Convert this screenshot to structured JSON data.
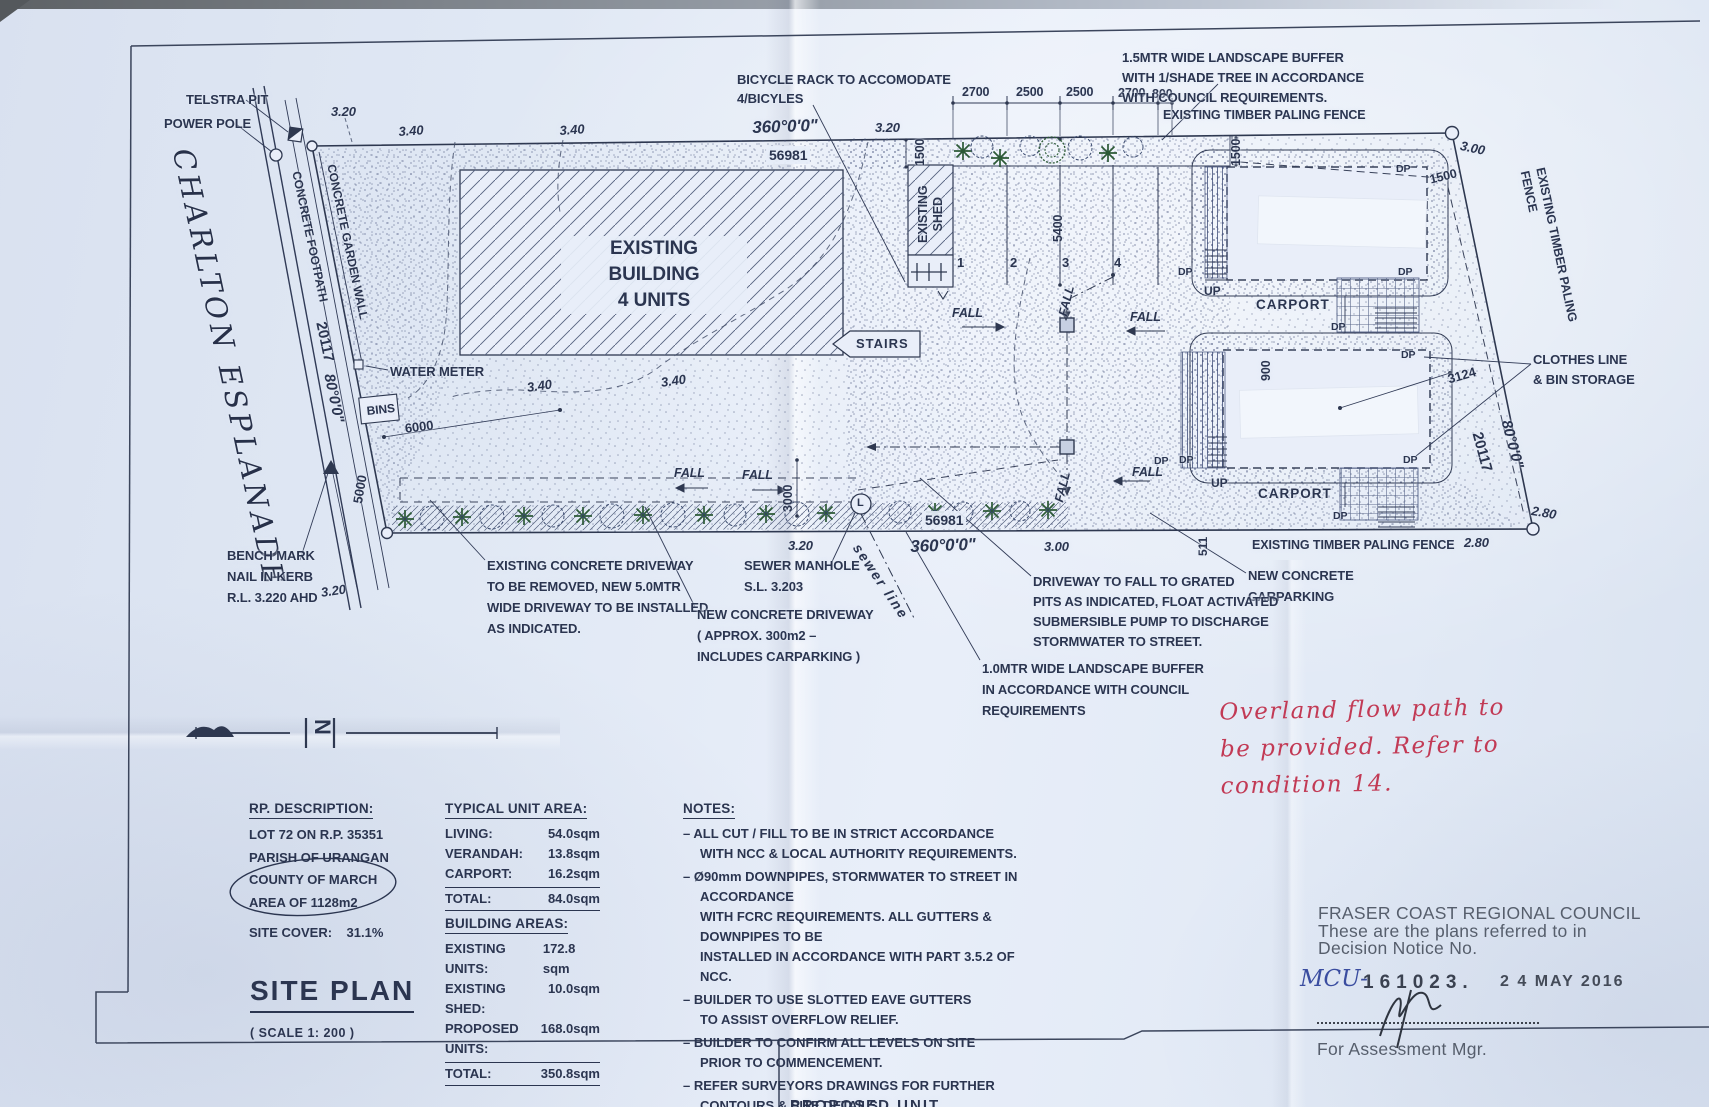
{
  "colors": {
    "ink": "#2b3550",
    "paper": "#e2e9f6",
    "red_pen": "#c23a55",
    "blue_pen": "#3a4da0",
    "tree_green": "#2c5a36",
    "stamp_gray": "#474f5c"
  },
  "plan_labels": [
    {
      "n": "telstra-pit-label",
      "t": "TELSTRA PIT",
      "x": 186,
      "y": 92
    },
    {
      "n": "power-pole-label",
      "t": "POWER POLE",
      "x": 164,
      "y": 116
    },
    {
      "n": "street-name",
      "t": "CHARLTON   ESPLANADE",
      "x": 200,
      "y": 145,
      "r": 78,
      "c": "street"
    },
    {
      "n": "level-320",
      "t": "3.20",
      "x": 331,
      "y": 104,
      "c": "dim"
    },
    {
      "n": "level-340",
      "t": "3.40",
      "x": 398,
      "y": 124,
      "c": "dim",
      "r": -4
    },
    {
      "n": "level-340",
      "t": "3.40",
      "x": 559,
      "y": 123,
      "c": "dim",
      "r": -4
    },
    {
      "n": "bearing-north",
      "t": "360°0'0\"",
      "x": 752,
      "y": 117,
      "s": 17,
      "c": "dim",
      "r": -2
    },
    {
      "n": "distance-north",
      "t": "56981",
      "x": 766,
      "y": 146,
      "s": 14,
      "bg": 1
    },
    {
      "n": "level-320",
      "t": "3.20",
      "x": 875,
      "y": 120,
      "c": "dim"
    },
    {
      "n": "dim-spacing",
      "t": "2700",
      "x": 962,
      "y": 84,
      "s": 12.5
    },
    {
      "n": "dim-spacing",
      "t": "2500",
      "x": 1016,
      "y": 84,
      "s": 12.5
    },
    {
      "n": "dim-spacing",
      "t": "2500",
      "x": 1066,
      "y": 84,
      "s": 12.5
    },
    {
      "n": "dim-spacing",
      "t": "2700",
      "x": 1118,
      "y": 85,
      "s": 12.5
    },
    {
      "n": "dim-spacing",
      "t": "800",
      "x": 1152,
      "y": 86,
      "s": 12.5
    },
    {
      "n": "note-landscape-buffer-1500",
      "t": "1.5MTR WIDE LANDSCAPE BUFFER\nWITH 1/SHADE TREE IN ACCORDANCE\nWITH COUNCIL REQUIREMENTS.",
      "x": 1122,
      "y": 48,
      "lh": 20
    },
    {
      "n": "fence-label-top",
      "t": "EXISTING TIMBER PALING FENCE",
      "x": 1163,
      "y": 107,
      "s": 12.5
    },
    {
      "n": "level-300",
      "t": "3.00",
      "x": 1462,
      "y": 138,
      "c": "dim",
      "r": 12
    },
    {
      "n": "dim-1500",
      "t": "1500",
      "x": 912,
      "y": 166,
      "r": -90,
      "s": 12.5
    },
    {
      "n": "existing-shed-label",
      "t": "EXISTING\nSHED",
      "x": 916,
      "y": 243,
      "r": -90,
      "s": 12.5,
      "lh": 15,
      "al": "center"
    },
    {
      "n": "dim-5400",
      "t": "5400",
      "x": 1050,
      "y": 242,
      "r": -90,
      "s": 12.5
    },
    {
      "n": "carpark-bay-number",
      "t": "1",
      "x": 957,
      "y": 255
    },
    {
      "n": "carpark-bay-number",
      "t": "2",
      "x": 1010,
      "y": 255
    },
    {
      "n": "carpark-bay-number",
      "t": "3",
      "x": 1062,
      "y": 255
    },
    {
      "n": "carpark-bay-number",
      "t": "4",
      "x": 1114,
      "y": 255
    },
    {
      "n": "dim-1500",
      "t": "1500",
      "x": 1228,
      "y": 166,
      "r": -90,
      "s": 12.5
    },
    {
      "n": "dim-1500",
      "t": "1500",
      "x": 1428,
      "y": 172,
      "r": -14,
      "s": 12.5
    },
    {
      "n": "downpipe-label",
      "t": "DP",
      "x": 1396,
      "y": 163,
      "s": 10.5
    },
    {
      "n": "downpipe-label",
      "t": "DP",
      "x": 1178,
      "y": 266,
      "s": 10.5
    },
    {
      "n": "downpipe-label",
      "t": "DP",
      "x": 1398,
      "y": 266,
      "s": 10.5
    },
    {
      "n": "downpipe-label",
      "t": "DP",
      "x": 1331,
      "y": 321,
      "s": 10.5
    },
    {
      "n": "downpipe-label",
      "t": "DP",
      "x": 1401,
      "y": 349,
      "s": 10.5
    },
    {
      "n": "downpipe-label",
      "t": "DP",
      "x": 1179,
      "y": 454,
      "s": 10.5
    },
    {
      "n": "downpipe-label",
      "t": "DP",
      "x": 1403,
      "y": 454,
      "s": 10.5
    },
    {
      "n": "downpipe-label",
      "t": "DP",
      "x": 1333,
      "y": 510,
      "s": 10.5
    },
    {
      "n": "downpipe-label",
      "t": "DP",
      "x": 1154,
      "y": 455,
      "s": 10.5
    },
    {
      "n": "up-label",
      "t": "UP",
      "x": 1204,
      "y": 284,
      "s": 12
    },
    {
      "n": "up-label",
      "t": "UP",
      "x": 1211,
      "y": 476,
      "s": 12
    },
    {
      "n": "carport-label",
      "t": "CARPORT",
      "x": 1256,
      "y": 296,
      "s": 13.5,
      "ls": 1
    },
    {
      "n": "carport-label",
      "t": "CARPORT",
      "x": 1258,
      "y": 485,
      "s": 13.5,
      "ls": 1
    },
    {
      "n": "dim-900",
      "t": "900",
      "x": 1258,
      "y": 381,
      "r": -90,
      "s": 12.5
    },
    {
      "n": "dim-3124",
      "t": "3124",
      "x": 1446,
      "y": 372,
      "r": -16,
      "s": 13
    },
    {
      "n": "note-clothes-line",
      "t": "CLOTHES LINE\n& BIN STORAGE",
      "x": 1533,
      "y": 350,
      "lh": 20
    },
    {
      "n": "fence-label-right",
      "t": "EXISTING TIMBER PALING FENCE",
      "x": 1548,
      "y": 166,
      "r": 78,
      "s": 12.5
    },
    {
      "n": "dim-20117",
      "t": "20117",
      "x": 1486,
      "y": 430,
      "r": 75,
      "s": 15
    },
    {
      "n": "bearing-east",
      "t": "80°0'0\"",
      "x": 1515,
      "y": 418,
      "r": 75,
      "s": 15,
      "c": "dim"
    },
    {
      "n": "level-280",
      "t": "2.80",
      "x": 1533,
      "y": 503,
      "c": "dim",
      "r": 10
    },
    {
      "n": "level-280",
      "t": "2.80",
      "x": 1464,
      "y": 535,
      "c": "dim"
    },
    {
      "n": "fence-label-bottom",
      "t": "EXISTING TIMBER PALING FENCE",
      "x": 1252,
      "y": 537,
      "s": 12.5
    },
    {
      "n": "dim-511",
      "t": "511",
      "x": 1196,
      "y": 556,
      "r": -90,
      "s": 12
    },
    {
      "n": "note-new-concrete-carparking",
      "t": "NEW CONCRETE\nCARPARKING",
      "x": 1248,
      "y": 565,
      "lh": 21
    },
    {
      "n": "water-meter-label",
      "t": "WATER METER",
      "x": 390,
      "y": 364
    },
    {
      "n": "bins-label",
      "t": "BINS",
      "x": 366,
      "y": 404,
      "s": 12,
      "r": -6
    },
    {
      "n": "dim-6000",
      "t": "6000",
      "x": 404,
      "y": 421,
      "r": -7,
      "s": 13
    },
    {
      "n": "dim-5000",
      "t": "5000",
      "x": 350,
      "y": 502,
      "r": -80,
      "s": 13
    },
    {
      "n": "level-320",
      "t": "3.20",
      "x": 320,
      "y": 585,
      "c": "dim",
      "r": -8
    },
    {
      "n": "benchmark-note",
      "t": "BENCH MARK\nNAIL IN KERB\nR.L. 3.220 AHD",
      "x": 227,
      "y": 545,
      "lh": 21
    },
    {
      "n": "footpath-label",
      "t": "CONCRETE FOOTPATH",
      "x": 303,
      "y": 170,
      "r": 78,
      "s": 12
    },
    {
      "n": "garden-wall-label",
      "t": "CONCRETE GARDEN WALL",
      "x": 338,
      "y": 163,
      "r": 78,
      "s": 12
    },
    {
      "n": "dim-20117",
      "t": "20117",
      "x": 330,
      "y": 320,
      "r": 78,
      "s": 15
    },
    {
      "n": "bearing-west",
      "t": "80°0'0\"",
      "x": 338,
      "y": 372,
      "r": 78,
      "s": 15,
      "c": "dim"
    },
    {
      "n": "level-340",
      "t": "3.40",
      "x": 526,
      "y": 380,
      "c": "dim",
      "r": -8
    },
    {
      "n": "level-340",
      "t": "3.40",
      "x": 660,
      "y": 375,
      "c": "dim",
      "r": -8
    },
    {
      "n": "stairs-label",
      "t": "STAIRS",
      "x": 856,
      "y": 336,
      "s": 13,
      "ls": 1
    },
    {
      "n": "fall-label",
      "t": "FALL",
      "x": 952,
      "y": 305,
      "c": "dim",
      "s": 12.5
    },
    {
      "n": "fall-label",
      "t": "FALL",
      "x": 1130,
      "y": 309,
      "c": "dim",
      "s": 12.5
    },
    {
      "n": "fall-label",
      "t": "FALL",
      "x": 1132,
      "y": 464,
      "c": "dim",
      "s": 12.5
    },
    {
      "n": "fall-label",
      "t": "FALL",
      "x": 674,
      "y": 465,
      "c": "dim",
      "s": 12.5
    },
    {
      "n": "fall-label",
      "t": "FALL",
      "x": 742,
      "y": 467,
      "c": "dim",
      "s": 12.5
    },
    {
      "n": "fall-label",
      "t": "FALL",
      "x": 1055,
      "y": 314,
      "c": "dim",
      "s": 12.5,
      "r": -76
    },
    {
      "n": "fall-label",
      "t": "FALL",
      "x": 1051,
      "y": 500,
      "c": "dim",
      "s": 12.5,
      "r": -76
    },
    {
      "n": "dim-3000",
      "t": "3000",
      "x": 780,
      "y": 512,
      "r": -90,
      "s": 12.5
    },
    {
      "n": "distance-south",
      "t": "56981",
      "x": 922,
      "y": 511,
      "s": 14,
      "bg": 1
    },
    {
      "n": "bearing-south",
      "t": "360°0'0\"",
      "x": 910,
      "y": 536,
      "s": 17,
      "c": "dim",
      "r": -2
    },
    {
      "n": "level-320",
      "t": "3.20",
      "x": 788,
      "y": 538,
      "c": "dim"
    },
    {
      "n": "level-300",
      "t": "3.00",
      "x": 1044,
      "y": 539,
      "c": "dim"
    },
    {
      "n": "sewer-line-label",
      "t": "sewer  line",
      "x": 864,
      "y": 540,
      "r": 56,
      "s": 14,
      "c": "dim",
      "ls": 2
    },
    {
      "n": "manhole-letter",
      "t": "L",
      "x": 857,
      "y": 496,
      "s": 11
    },
    {
      "n": "note-sewer-manhole",
      "t": "SEWER MANHOLE\nS.L. 3.203",
      "x": 744,
      "y": 555,
      "lh": 21
    },
    {
      "n": "note-existing-driveway",
      "t": "EXISTING CONCRETE DRIVEWAY\nTO BE REMOVED, NEW 5.0MTR\nWIDE DRIVEWAY TO BE INSTALLED\nAS INDICATED.",
      "x": 487,
      "y": 555,
      "lh": 21
    },
    {
      "n": "note-new-driveway",
      "t": "NEW CONCRETE DRIVEWAY\n( APPROX. 300m2 –\nINCLUDES CARPARKING )",
      "x": 697,
      "y": 604,
      "lh": 21
    },
    {
      "n": "note-driveway-fall",
      "t": "DRIVEWAY TO FALL TO GRATED\nPITS AS INDICATED, FLOAT ACTIVATED\nSUBMERSIBLE PUMP TO DISCHARGE\nSTORMWATER TO STREET.",
      "x": 1033,
      "y": 572,
      "lh": 20
    },
    {
      "n": "note-landscape-buffer-1000",
      "t": "1.0MTR WIDE LANDSCAPE BUFFER\nIN ACCORDANCE WITH COUNCIL\nREQUIREMENTS",
      "x": 982,
      "y": 658,
      "lh": 21
    },
    {
      "n": "note-bicycle-rack",
      "t": "BICYCLE RACK TO ACCOMODATE\n4/BICYLES",
      "x": 737,
      "y": 70,
      "lh": 19
    },
    {
      "n": "building-label",
      "t": "EXISTING BUILDING\n4 UNITS",
      "x": 561,
      "y": 236,
      "s": 19,
      "lh": 26,
      "al": "center",
      "w": 180,
      "bg": 1
    },
    {
      "n": "north-letter",
      "t": "N",
      "x": 336,
      "y": 719,
      "r": 90,
      "s": 22,
      "b": 1
    },
    {
      "n": "titleblock-partial",
      "t": "PROPOSED UNIT",
      "x": 790,
      "y": 1096,
      "s": 15,
      "ls": 2,
      "b": 1
    }
  ],
  "rp": {
    "heading": "RP. DESCRIPTION:",
    "lot": "LOT 72 ON R.P. 35351",
    "parish": "PARISH OF URANGAN",
    "county": "COUNTY OF MARCH",
    "area": "AREA OF 1128m2",
    "site_cover_label": "SITE COVER:",
    "site_cover_value": "31.1%"
  },
  "site_plan": {
    "title": "SITE PLAN",
    "scale": "( SCALE 1: 200 )"
  },
  "tables": {
    "unit_area": {
      "heading": "TYPICAL UNIT AREA:",
      "rows": [
        [
          "LIVING:",
          "54.0sqm"
        ],
        [
          "VERANDAH:",
          "13.8sqm"
        ],
        [
          "CARPORT:",
          "16.2sqm"
        ]
      ],
      "total": [
        "TOTAL:",
        "84.0sqm"
      ]
    },
    "building_areas": {
      "heading": "BUILDING AREAS:",
      "rows": [
        [
          "EXISTING UNITS:",
          "172.8 sqm"
        ],
        [
          "EXISTING SHED:",
          "10.0sqm"
        ],
        [
          "PROPOSED UNITS:",
          "168.0sqm"
        ]
      ],
      "total": [
        "TOTAL:",
        "350.8sqm"
      ]
    }
  },
  "notes": {
    "heading": "NOTES:",
    "items": [
      [
        "– ALL CUT / FILL TO BE IN STRICT ACCORDANCE",
        "WITH NCC & LOCAL AUTHORITY REQUIREMENTS."
      ],
      [
        "– Ø90mm DOWNPIPES, STORMWATER TO STREET IN ACCORDANCE",
        "WITH FCRC REQUIREMENTS. ALL GUTTERS & DOWNPIPES TO BE",
        "INSTALLED IN ACCORDANCE WITH PART 3.5.2 OF NCC."
      ],
      [
        "– BUILDER TO USE SLOTTED EAVE GUTTERS",
        "TO ASSIST OVERFLOW RELIEF."
      ],
      [
        "– BUILDER TO CONFIRM ALL LEVELS ON SITE",
        "PRIOR TO COMMENCEMENT."
      ],
      [
        "– REFER SURVEYORS DRAWINGS FOR FURTHER",
        "CONTOURS & SITE DETAILS."
      ]
    ]
  },
  "council": {
    "line1": "FRASER COAST REGIONAL COUNCIL",
    "line2": "These are the plans referred to in",
    "line3": "Decision Notice No.",
    "mcu": "MCU-",
    "number": "161023.",
    "date": "2 4 MAY 2016",
    "for_line": "For Assessment Mgr."
  },
  "red_note": {
    "lines": [
      "Overland  flow  path  to",
      "be  provided.  Refer  to",
      "condition  14."
    ]
  }
}
